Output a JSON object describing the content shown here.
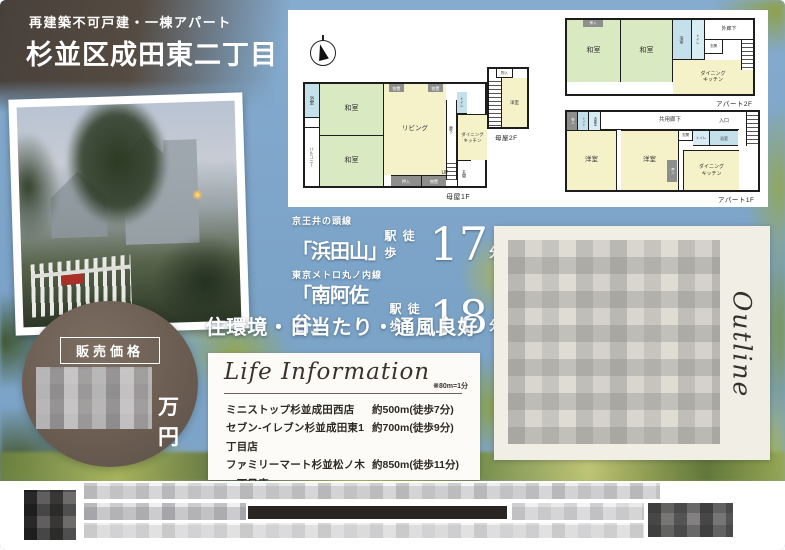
{
  "header": {
    "subtitle": "再建築不可戸建・一棟アパート",
    "title": "杉並区成田東二丁目"
  },
  "floorplans": {
    "main_1f": {
      "caption": "母屋1F",
      "rooms": {
        "bath": "浴室",
        "balcony": "バルコニー",
        "japanese_room_1": "和室",
        "japanese_room_2": "和室",
        "living": "リビング",
        "storage_1": "物置",
        "storage_2": "物置",
        "hall": "廊下",
        "toilet": "トイレ",
        "dining_kitchen": "ダイニング\nキッチン",
        "stairs": "UP",
        "entrance": "玄関",
        "closet": "押入",
        "storage_3": "物置"
      }
    },
    "main_2f": {
      "caption": "母屋2F",
      "rooms": {
        "closet": "物入",
        "western_room": "洋室"
      }
    },
    "apt_2f": {
      "caption": "アパート2F",
      "rooms": {
        "closet": "押入",
        "japanese_room_1": "和室",
        "japanese_room_2": "和室",
        "bath": "浴室",
        "toilet": "トイレ",
        "outer_corridor": "外廊下",
        "entrance": "玄関",
        "dining_kitchen": "ダイニング\nキッチン"
      }
    },
    "apt_1f": {
      "caption": "アパート1F",
      "rooms": {
        "storage": "物入",
        "toilet_1": "トイレ",
        "washroom": "洗面室",
        "common_corridor": "共用廊下",
        "entry": "入口",
        "western_room_1": "洋室",
        "western_room_2": "洋室",
        "entrance": "玄関",
        "toilet_2": "トイレ",
        "bath": "浴室",
        "closet": "押入",
        "dining_kitchen": "ダイニング\nキッチン"
      }
    }
  },
  "access": {
    "lines": [
      {
        "railway": "京王井の頭線",
        "station": "「浜田山」",
        "suffix": "駅 徒歩",
        "minutes": "17",
        "unit": "分"
      },
      {
        "railway": "東京メトロ丸ノ内線",
        "station": "「南阿佐谷」",
        "suffix": "駅 徒歩",
        "minutes": "18",
        "unit": "分"
      }
    ]
  },
  "catchphrase": "住環境・日当たり・通風良好",
  "price": {
    "label": "販売価格",
    "unit": "万円"
  },
  "life_info": {
    "title": "Life Information",
    "note": "※80m=1分",
    "items": [
      {
        "name": "ミニストップ杉並成田西店",
        "distance": "約500m(徒歩7分)"
      },
      {
        "name": "セブン-イレブン杉並成田東1丁目店",
        "distance": "約700m(徒歩9分)"
      },
      {
        "name": "ファミリーマート杉並松ノ木一丁目店",
        "distance": "約850m(徒歩11分)"
      },
      {
        "name": "サミットストア成田東店",
        "distance": "約850m(徒歩11分)"
      }
    ]
  },
  "outline": {
    "title": "Outline"
  },
  "colors": {
    "sky_blue": "#7ba3c7",
    "header_brown": "#4e443c",
    "tatami_green": "#d9e9c1",
    "plan_cream": "#f5f2c9",
    "plan_blue": "#c3e0eb",
    "price_circle_brown": "#6b5d52",
    "panel_offwhite": "#f1eee5"
  }
}
